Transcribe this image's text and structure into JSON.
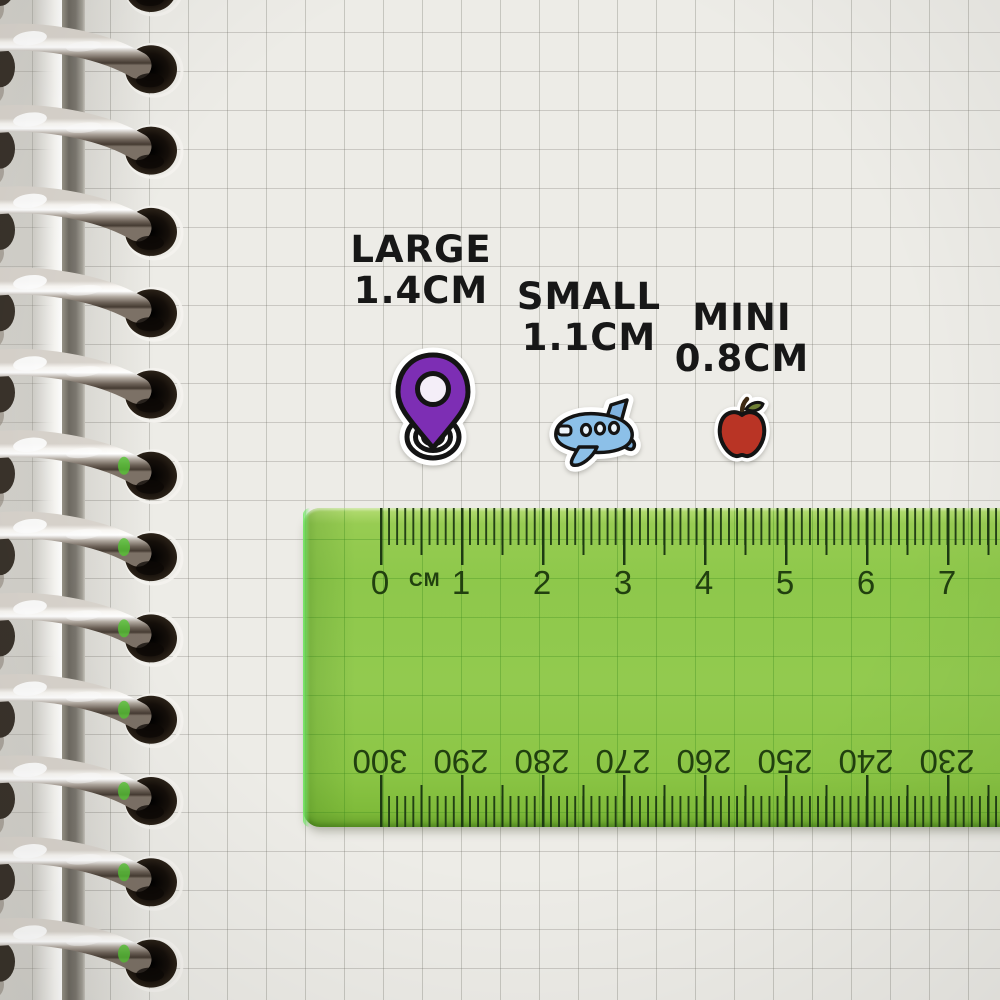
{
  "labels": [
    {
      "id": "large",
      "name": "LARGE",
      "size": "1.4CM"
    },
    {
      "id": "small",
      "name": "SMALL",
      "size": "1.1CM"
    },
    {
      "id": "mini",
      "name": "MINI",
      "size": "0.8CM"
    }
  ],
  "stickers": [
    {
      "icon": "location-pin-icon",
      "label": "LARGE",
      "color": "#7d2eb4"
    },
    {
      "icon": "airplane-icon",
      "label": "SMALL",
      "color": "#8cc0e8"
    },
    {
      "icon": "apple-icon",
      "label": "MINI",
      "color": "#b93425"
    }
  ],
  "ruler": {
    "unit_label": "CM",
    "top_scale_numbers": [
      "0",
      "1",
      "2",
      "3",
      "4",
      "5",
      "6",
      "7"
    ],
    "bottom_scale_numbers": [
      "300",
      "290",
      "280",
      "270",
      "260",
      "250",
      "240",
      "230"
    ],
    "body_color": "#8ec84b",
    "marking_color": "#1d3a12"
  },
  "notebook": {
    "ring_count": 13,
    "paper_color": "#edece7",
    "grid_color": "#c3c1ba"
  }
}
